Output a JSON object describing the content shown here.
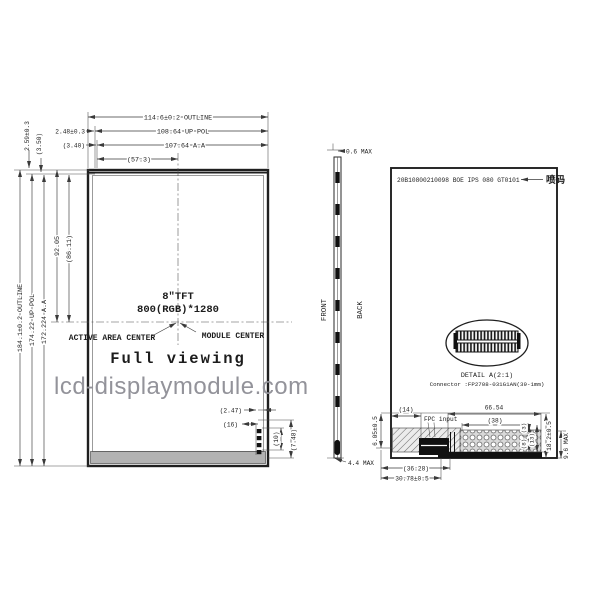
{
  "watermark": "lcd-displaymodule.com",
  "colors": {
    "line": "#3a3a3a",
    "text": "#1c1c1c",
    "watermark_gray": "#93939a",
    "shade_gray": "#b3b3b3",
    "black_fill": "#111111"
  },
  "front": {
    "top": {
      "outline": "114.6±0.2 OUTLINE",
      "up_pol": "108.64 UP POL",
      "aa": "107.64 A.A",
      "center_half": "(57.3)",
      "margin": "2.48±0.3",
      "margin_pol": "(3.40)"
    },
    "left": {
      "outline": "184.1±0.2 OUTLINE",
      "up_pol": "174.22 UP POL",
      "aa": "172.224 A.A",
      "center_half": "92.05",
      "center_half_aa": "(86.11)",
      "margin": "2.59±0.3",
      "margin_pol": "(3.50)"
    },
    "center": {
      "size": "8\"TFT",
      "resolution": "800(RGB)*1280",
      "active_area_center": "ACTIVE AREA CENTER",
      "module_center": "MODULE CENTER",
      "full_viewing": "Full viewing"
    },
    "corner": {
      "d1": "(2.47)",
      "d2": "(16)",
      "d3": "(10)",
      "d4": "(7.48)"
    }
  },
  "side": {
    "top_thickness": "0.6 MAX",
    "bottom_thickness": "4.4 MAX",
    "front_label": "FRONT",
    "back_label": "BACK"
  },
  "back": {
    "serial": "20B10800210098 BOE IPS 080 GT0101",
    "marking": "喷码",
    "detail_title": "DETAIL A(2:1)",
    "connector": "Connector :FP2708-031G1AN(39-1mm)",
    "fpc_input": "FPC input",
    "dims": {
      "top_left": "(14)",
      "width": "66.54",
      "stiffener": "(38)",
      "left_v": "6.05±0.5",
      "bottom_outer": "(36.28)",
      "bottom_inner": "30.78±0.5",
      "r_small1": "(3)",
      "r_small2": "(8)",
      "r_mid": "(13)",
      "r_outer": "18.2±0.5",
      "thickness": "9.6 MAX"
    }
  }
}
